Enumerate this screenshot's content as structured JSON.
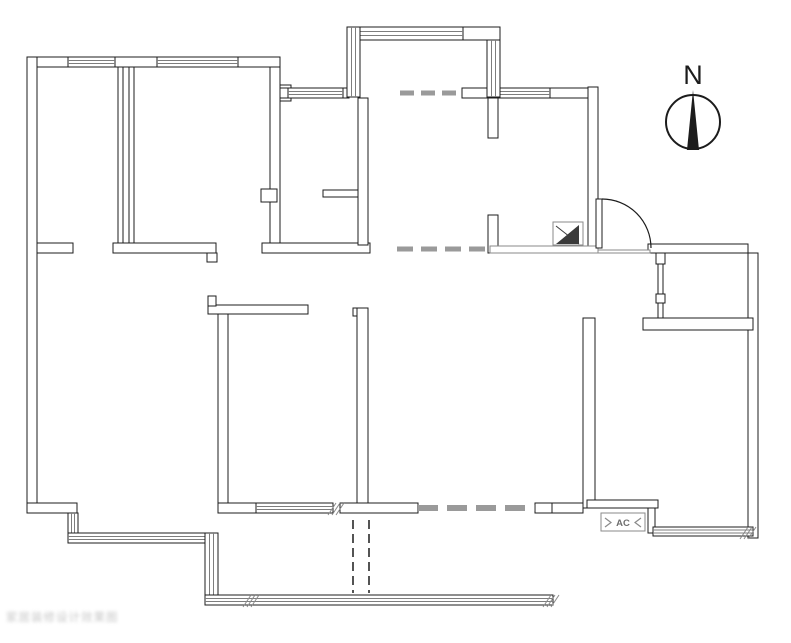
{
  "plan": {
    "canvas": {
      "width": 791,
      "height": 643
    },
    "colors": {
      "line": "#1c1c1c",
      "gray": "#8a8a8a",
      "window_inner": "#7d7d7d",
      "dash_gray": "#9a9a9a",
      "fill": "#ffffff",
      "flue_fill": "#3a3a3a"
    },
    "walls_black": [
      [
        27,
        57,
        253,
        10
      ],
      [
        27,
        57,
        10,
        456
      ],
      [
        270,
        67,
        10,
        186
      ],
      [
        280,
        85,
        11,
        16
      ],
      [
        261,
        189,
        16,
        13
      ],
      [
        118,
        67,
        5,
        176
      ],
      [
        129,
        67,
        5,
        176
      ],
      [
        37,
        243,
        36,
        10
      ],
      [
        113,
        243,
        103,
        10
      ],
      [
        207,
        253,
        10,
        9
      ],
      [
        262,
        243,
        108,
        10
      ],
      [
        280,
        88,
        8,
        10
      ],
      [
        343,
        88,
        6,
        10
      ],
      [
        463,
        27,
        37,
        13
      ],
      [
        495,
        88,
        6,
        10
      ],
      [
        550,
        88,
        48,
        10
      ],
      [
        588,
        87,
        10,
        166
      ],
      [
        462,
        88,
        25,
        10
      ],
      [
        358,
        98,
        10,
        147
      ],
      [
        323,
        190,
        35,
        7
      ],
      [
        488,
        98,
        10,
        40
      ],
      [
        488,
        215,
        10,
        38
      ],
      [
        648,
        244,
        100,
        9
      ],
      [
        748,
        253,
        10,
        285
      ],
      [
        643,
        318,
        110,
        12
      ],
      [
        658,
        253,
        5,
        65
      ],
      [
        656,
        253,
        9,
        11
      ],
      [
        656,
        294,
        9,
        9
      ],
      [
        583,
        318,
        12,
        190
      ],
      [
        587,
        500,
        71,
        8
      ],
      [
        648,
        508,
        7,
        25
      ],
      [
        218,
        313,
        10,
        190
      ],
      [
        208,
        305,
        100,
        9
      ],
      [
        208,
        296,
        8,
        10
      ],
      [
        353,
        308,
        15,
        8
      ],
      [
        357,
        308,
        11,
        205
      ],
      [
        27,
        503,
        50,
        10
      ],
      [
        340,
        503,
        78,
        10
      ],
      [
        535,
        503,
        17,
        10
      ],
      [
        552,
        503,
        31,
        10
      ],
      [
        218,
        503,
        38,
        10
      ],
      [
        395,
        595,
        12,
        10
      ]
    ],
    "walls_gray": [
      [
        490,
        246,
        108,
        7
      ],
      [
        598,
        250,
        52,
        3
      ]
    ],
    "windows": [
      {
        "x": 68,
        "y": 57,
        "w": 47,
        "h": 10,
        "dir": "h"
      },
      {
        "x": 157,
        "y": 57,
        "w": 81,
        "h": 10,
        "dir": "h"
      },
      {
        "x": 288,
        "y": 88,
        "w": 55,
        "h": 10,
        "dir": "h"
      },
      {
        "x": 500,
        "y": 88,
        "w": 50,
        "h": 10,
        "dir": "h"
      },
      {
        "x": 347,
        "y": 27,
        "w": 116,
        "h": 13,
        "dir": "h"
      },
      {
        "x": 347,
        "y": 27,
        "w": 13,
        "h": 70,
        "dir": "v"
      },
      {
        "x": 487,
        "y": 40,
        "w": 13,
        "h": 57,
        "dir": "v"
      },
      {
        "x": 256,
        "y": 503,
        "w": 77,
        "h": 10,
        "dir": "h"
      },
      {
        "x": 68,
        "y": 513,
        "w": 10,
        "h": 24,
        "dir": "v"
      },
      {
        "x": 68,
        "y": 533,
        "w": 140,
        "h": 10,
        "dir": "h"
      },
      {
        "x": 205,
        "y": 533,
        "w": 13,
        "h": 62,
        "dir": "v"
      },
      {
        "x": 205,
        "y": 595,
        "w": 348,
        "h": 10,
        "dir": "h"
      },
      {
        "x": 653,
        "y": 527,
        "w": 100,
        "h": 9,
        "dir": "h"
      }
    ],
    "dashes": [
      {
        "x1": 353,
        "y1": 520,
        "x2": 353,
        "y2": 593,
        "w": 1.5,
        "dash": "9 5",
        "color": "#1c1c1c"
      },
      {
        "x1": 369,
        "y1": 520,
        "x2": 369,
        "y2": 593,
        "w": 1.5,
        "dash": "9 5",
        "color": "#1c1c1c"
      },
      {
        "x1": 418,
        "y1": 508,
        "x2": 535,
        "y2": 508,
        "w": 6,
        "dash": "20 9",
        "color": "#9a9a9a"
      },
      {
        "x1": 397,
        "y1": 249,
        "x2": 490,
        "y2": 249,
        "w": 5,
        "dash": "16 8",
        "color": "#9a9a9a"
      },
      {
        "x1": 400,
        "y1": 93,
        "x2": 462,
        "y2": 93,
        "w": 5,
        "dash": "14 7",
        "color": "#9a9a9a"
      }
    ],
    "door": {
      "leaf": [
        596,
        199,
        6,
        49
      ],
      "arc": "M 602 199 A 49 49 0 0 1 651 248"
    },
    "flue": {
      "box": [
        553,
        222,
        30,
        23
      ],
      "triangle": [
        [
          556,
          244
        ],
        [
          579,
          225
        ],
        [
          579,
          244
        ]
      ],
      "diag": [
        556,
        226,
        579,
        244
      ]
    },
    "hatches": [
      [
        328,
        503
      ],
      [
        243,
        595
      ],
      [
        543,
        595
      ],
      [
        740,
        527
      ]
    ],
    "compass": {
      "cx": 693,
      "cy": 122,
      "r": 27,
      "label": "N",
      "label_x": 693,
      "label_y": 84,
      "needle": [
        [
          693,
          90
        ],
        [
          687,
          150
        ],
        [
          699,
          150
        ]
      ]
    },
    "ac": {
      "box": [
        601,
        513,
        44,
        18
      ],
      "label": "AC",
      "chev_left": "605,518 611,522.5 605,527",
      "chev_right": "641,518 635,522.5 641,527"
    }
  },
  "watermark": {
    "text": "家居装修设计效果图"
  }
}
